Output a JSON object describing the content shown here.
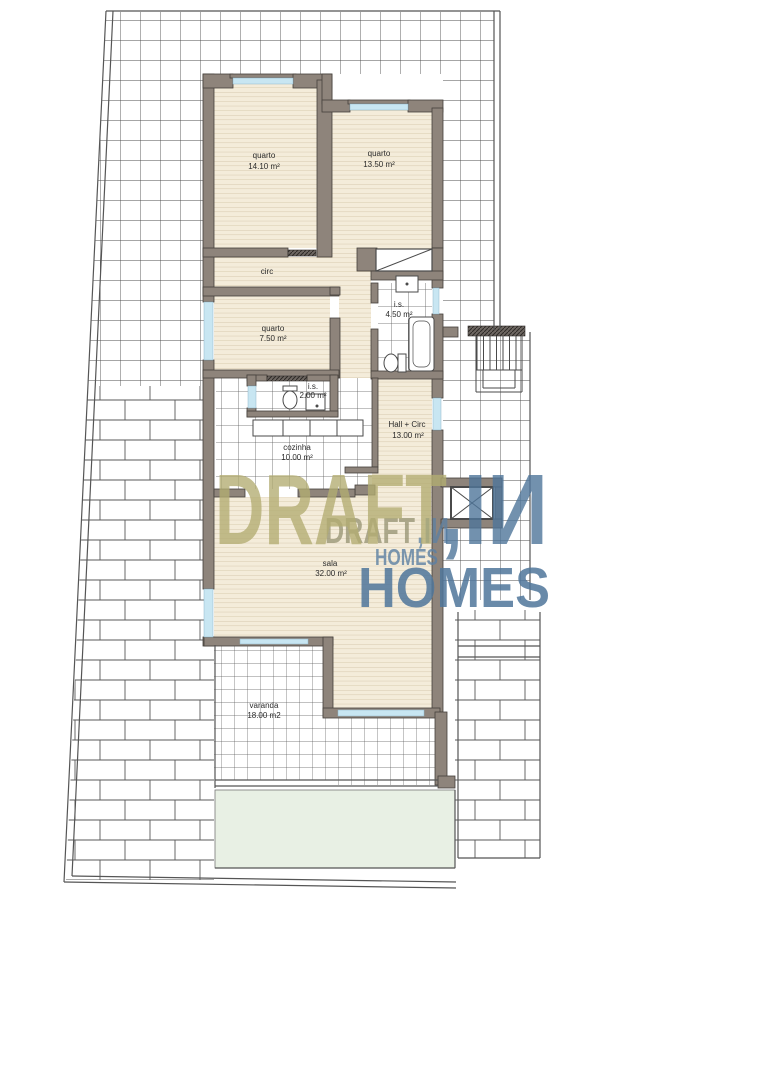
{
  "document": {
    "type": "apartment floor plan",
    "language": "pt"
  },
  "rooms": [
    {
      "id": "quarto-1",
      "label": "quarto",
      "area": "14.10 m²"
    },
    {
      "id": "quarto-2",
      "label": "quarto",
      "area": "13.50 m²"
    },
    {
      "id": "circ",
      "label": "circ",
      "area": ""
    },
    {
      "id": "quarto-3",
      "label": "quarto",
      "area": "7.50 m²"
    },
    {
      "id": "is-1",
      "label": "i.s.",
      "area": "4.50 m²"
    },
    {
      "id": "is-2",
      "label": "i.s.",
      "area": "2.00 m²"
    },
    {
      "id": "cozinha",
      "label": "cozinha",
      "area": "10.00 m²"
    },
    {
      "id": "hall",
      "label": "Hall + Circ",
      "area": "13.00 m²"
    },
    {
      "id": "sala",
      "label": "sala",
      "area": "32.00 m²"
    },
    {
      "id": "varanda",
      "label": "varanda",
      "area": "18.00 m2"
    }
  ],
  "watermark": {
    "large": {
      "word1": "DRAFT",
      "word2": ",IИ",
      "word3": "HOMES"
    },
    "small": {
      "word1": "DRAFT",
      "word2": ",IИ",
      "word3": "HOMES"
    }
  },
  "colors": {
    "wall": "#8e847b",
    "wall_edge": "#45403b",
    "wood": "#f4ecda",
    "wood_line": "#d5c7ab",
    "window_glass": "#c8e6f2",
    "tile_line": "#5a5a5a",
    "lawn": "#e8f0e4",
    "watermark_olive": "#b3ad72",
    "watermark_blue": "#4f769b"
  }
}
